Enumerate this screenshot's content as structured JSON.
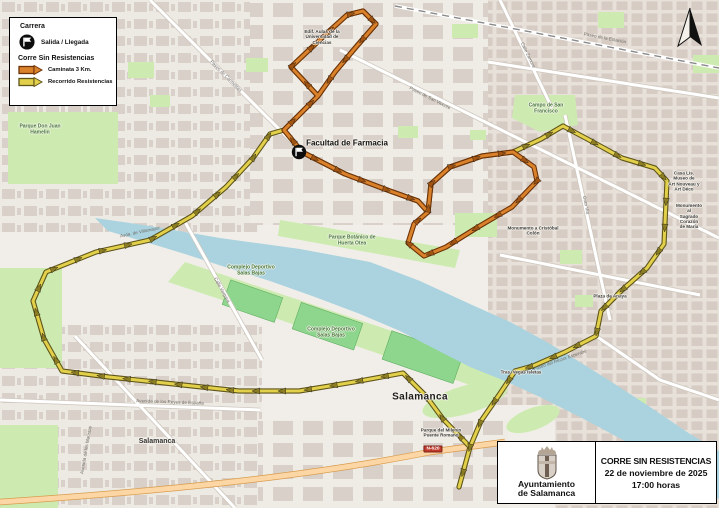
{
  "legend": {
    "title": "Carrera",
    "start_finish_label": "Salida / Llegada",
    "subtitle": "Corre Sin Resistencias",
    "routes": [
      {
        "label": "Caminata 3 Km.",
        "color": "#d9822b"
      },
      {
        "label": "Recorrido Resistencias",
        "color": "#e2d04b"
      }
    ]
  },
  "info_box": {
    "organizer": "Ayuntamiento\nde Salamanca",
    "title": "CORRE SIN RESISTENCIAS",
    "date": "22 de noviembre de 2025",
    "time": "17:00 horas"
  },
  "map": {
    "road_badge": "N-620",
    "colors": {
      "river": "#aad3df",
      "park": "#cdebb0",
      "pitch": "#8ed58e",
      "building": "#d9d0c9",
      "main_road": "#fcd6a4"
    },
    "labels": [
      {
        "text": "Facultad de Farmacia"
      },
      {
        "text": "Edif. Aulas de la\nUniversidad de\nCiencias"
      },
      {
        "text": "Campo de San\nFrancisco"
      },
      {
        "text": "Parque Botánico de\nHuerta Otea"
      },
      {
        "text": "Complejo Deportivo\nSalas Bajas"
      },
      {
        "text": "Complejo Deportivo\nSalas Bajas"
      },
      {
        "text": "Parque Don Juan\nHamelin"
      },
      {
        "text": "Monumento a Cristóbal\nColón"
      },
      {
        "text": "Casa Lis. Museo de\nArt Nouveau y\nArt Déco"
      },
      {
        "text": "Monumento al\nSagrado Corazón\nde María"
      },
      {
        "text": "Plaza de Anaya"
      },
      {
        "text": "Salamanca"
      },
      {
        "text": "Salamanca"
      },
      {
        "text": "Parque del Milenio\nPuente Romano"
      },
      {
        "text": "Tras. Vegas Isletas"
      }
    ],
    "street_labels": [
      {
        "text": "Paseo de San Vicente"
      },
      {
        "text": "Calle Zamora"
      },
      {
        "text": "Gran Vía"
      },
      {
        "text": "Paseo de Carmelitas"
      },
      {
        "text": "Avda. de Villamayor"
      },
      {
        "text": "Calle Vergara"
      },
      {
        "text": "Paseo del Rector Esperabé"
      },
      {
        "text": "Avenida de los Maristas"
      },
      {
        "text": "Paseo de la Estación"
      },
      {
        "text": "Avenida de los Reyes de España"
      }
    ],
    "routes": {
      "resistencias": {
        "label": "Recorrido Resistencias",
        "casing": "#5f551a",
        "core": "#e2d04b",
        "arrow": "#8c7c22",
        "paths": [
          [
            [
              302,
              152
            ],
            [
              284,
              130
            ],
            [
              318,
              96
            ],
            [
              291,
              67
            ],
            [
              326,
              34
            ],
            [
              347,
              15
            ],
            [
              363,
              11
            ],
            [
              376,
              24
            ],
            [
              356,
              47
            ],
            [
              335,
              72
            ],
            [
              318,
              96
            ]
          ],
          [
            [
              302,
              152
            ],
            [
              345,
              174
            ],
            [
              390,
              191
            ],
            [
              418,
              201
            ],
            [
              428,
              212
            ],
            [
              431,
              184
            ],
            [
              450,
              167
            ],
            [
              482,
              156
            ],
            [
              513,
              152
            ]
          ],
          [
            [
              513,
              152
            ],
            [
              541,
              139
            ],
            [
              563,
              126
            ],
            [
              591,
              141
            ],
            [
              622,
              158
            ],
            [
              655,
              168
            ],
            [
              667,
              181
            ],
            [
              664,
              244
            ],
            [
              647,
              268
            ],
            [
              621,
              291
            ],
            [
              601,
              311
            ],
            [
              596,
              336
            ],
            [
              565,
              352
            ],
            [
              533,
              366
            ],
            [
              515,
              371
            ],
            [
              499,
              395
            ],
            [
              481,
              421
            ],
            [
              470,
              447
            ],
            [
              459,
              487
            ]
          ],
          [
            [
              470,
              447
            ],
            [
              443,
              419
            ],
            [
              426,
              396
            ],
            [
              403,
              373
            ],
            [
              354,
              382
            ],
            [
              299,
              391
            ],
            [
              239,
              391
            ],
            [
              174,
              384
            ],
            [
              109,
              377
            ],
            [
              62,
              371
            ],
            [
              44,
              339
            ],
            [
              33,
              301
            ],
            [
              46,
              272
            ],
            [
              96,
              252
            ],
            [
              150,
              240
            ],
            [
              192,
              216
            ],
            [
              226,
              187
            ],
            [
              253,
              158
            ],
            [
              270,
              134
            ],
            [
              284,
              130
            ]
          ]
        ]
      },
      "caminata": {
        "label": "Caminata 3 Km.",
        "casing": "#6e3207",
        "core": "#d9822b",
        "arrow": "#a35410",
        "paths": [
          [
            [
              302,
              152
            ],
            [
              284,
              130
            ],
            [
              318,
              96
            ],
            [
              291,
              67
            ],
            [
              326,
              34
            ],
            [
              347,
              15
            ],
            [
              363,
              11
            ],
            [
              376,
              24
            ],
            [
              356,
              47
            ],
            [
              335,
              72
            ],
            [
              318,
              96
            ]
          ],
          [
            [
              302,
              152
            ],
            [
              345,
              174
            ],
            [
              390,
              191
            ],
            [
              418,
              201
            ],
            [
              428,
              212
            ],
            [
              431,
              184
            ],
            [
              450,
              167
            ],
            [
              482,
              156
            ],
            [
              513,
              152
            ],
            [
              534,
              167
            ],
            [
              537,
              181
            ],
            [
              512,
              207
            ],
            [
              478,
              227
            ],
            [
              446,
              247
            ],
            [
              424,
              256
            ],
            [
              408,
              243
            ],
            [
              414,
              224
            ],
            [
              428,
              212
            ]
          ]
        ]
      }
    }
  }
}
